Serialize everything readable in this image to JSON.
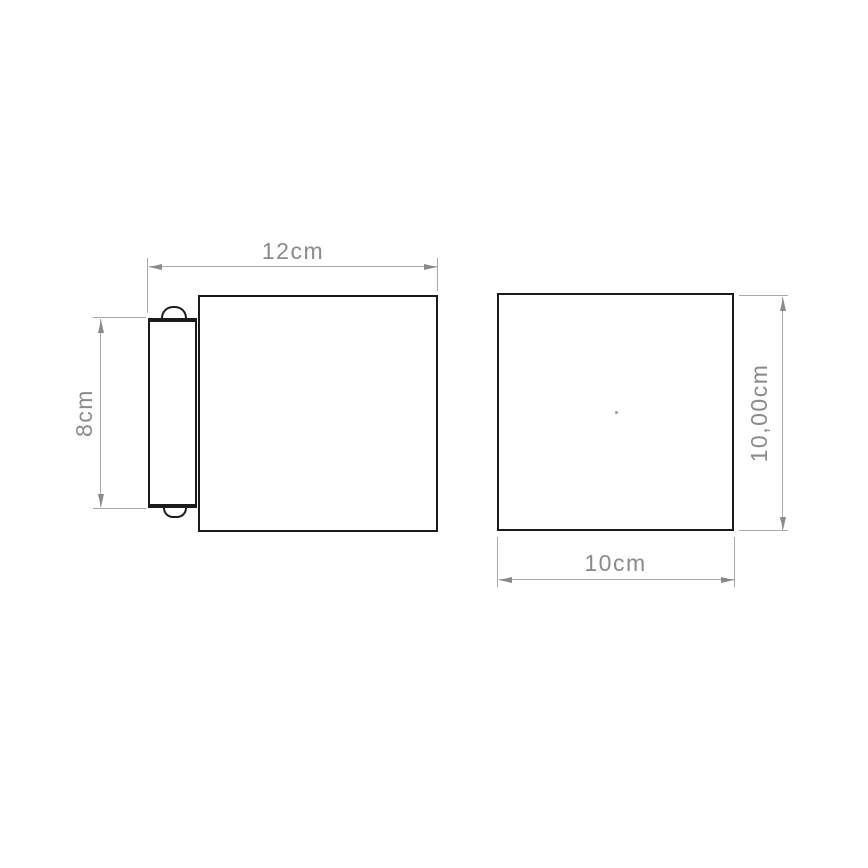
{
  "drawing": {
    "kind": "dimension diagram",
    "views": {
      "side": {
        "name": "side view",
        "width_dim_label": "12cm",
        "height_dim_label": "8cm"
      },
      "front": {
        "name": "front view",
        "width_dim_label": "10cm",
        "height_dim_label": "10,00cm"
      }
    },
    "colors": {
      "outline": "#1b1b1b",
      "dim_line": "#a8a8a8",
      "dim_text": "#8a8a8a",
      "background": "#ffffff"
    }
  }
}
